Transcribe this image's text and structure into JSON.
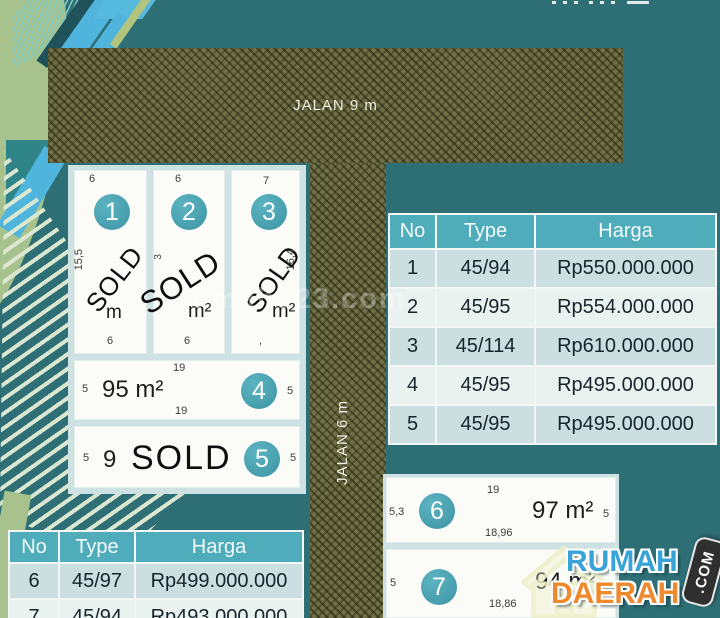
{
  "labels": {
    "sold": "SOLD"
  },
  "roads": {
    "horizontal": {
      "label": "JALAN 9 m"
    },
    "vertical": {
      "label": "JALAN 6 m"
    }
  },
  "watermark": {
    "text": "rumah123.com"
  },
  "plots": [
    {
      "no": "1",
      "top": "6",
      "left": "15,5",
      "area": "m",
      "bottom": "6"
    },
    {
      "no": "2",
      "top": "6",
      "left": "3",
      "area": "m²",
      "bottom": "6"
    },
    {
      "no": "3",
      "top": "7",
      "right": "16,4",
      "area": "m²",
      "bottom": ","
    },
    {
      "no": "4",
      "top": "19",
      "left": "5",
      "right": "5",
      "area": "95 m²",
      "bottom": "19"
    },
    {
      "no": "5",
      "left": "5",
      "right": "5",
      "area": "9"
    },
    {
      "no": "6",
      "top": "19",
      "left": "5,3",
      "right": "5",
      "area": "97 m²",
      "bottom": "18,96"
    },
    {
      "no": "7",
      "left": "5",
      "right": "5",
      "area": "94 m²",
      "bottom": "18,86"
    }
  ],
  "tables": {
    "right": {
      "headers": [
        "No",
        "Type",
        "Harga"
      ],
      "rows": [
        [
          "1",
          "45/94",
          "Rp550.000.000"
        ],
        [
          "2",
          "45/95",
          "Rp554.000.000"
        ],
        [
          "3",
          "45/114",
          "Rp610.000.000"
        ],
        [
          "4",
          "45/95",
          "Rp495.000.000"
        ],
        [
          "5",
          "45/95",
          "Rp495.000.000"
        ]
      ]
    },
    "bottom": {
      "headers": [
        "No",
        "Type",
        "Harga"
      ],
      "rows": [
        [
          "6",
          "45/97",
          "Rp499.000.000"
        ],
        [
          "7",
          "45/94",
          "Rp493.000.000"
        ]
      ]
    }
  },
  "logo": {
    "line1": "RUMAH",
    "line2": "DAERAH",
    "badge": ".COM"
  },
  "colors": {
    "background_teal": "#2E6E75",
    "road_olive": "#707046",
    "table_header_teal": "#4FACBB",
    "circle_teal": "#4AA4B4",
    "logo_blue": "#39A3D8",
    "logo_orange": "#EE8A2D",
    "sage_green": "#A7C28D"
  }
}
